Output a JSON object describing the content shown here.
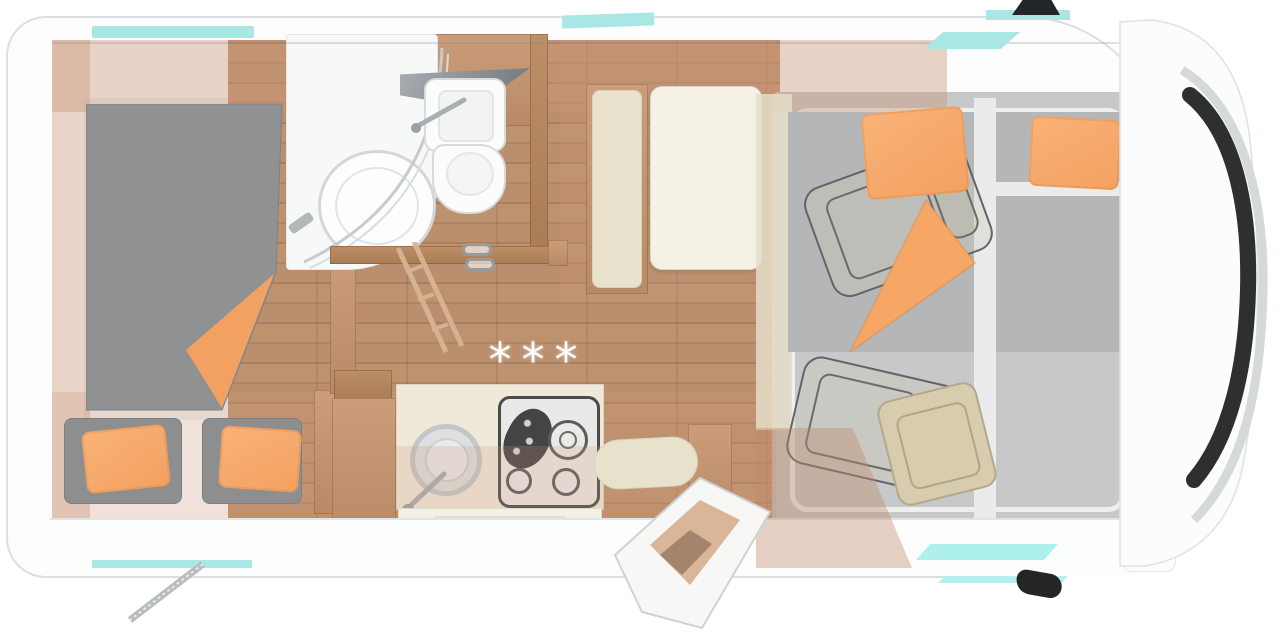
{
  "meta": {
    "description": "Top-down floor plan rendering of a semi-integrated motorhome",
    "view": "top-down"
  },
  "floorplan": {
    "stars_label": "***",
    "elements": [
      {
        "id": "rear-bed",
        "label": "Rear double bed with orange blanket"
      },
      {
        "id": "rear-seats",
        "label": "Rear bench seats with orange pillows"
      },
      {
        "id": "bathroom",
        "label": "Bathroom with shower, washbasin and toilet"
      },
      {
        "id": "wardrobe",
        "label": "Wardrobe / partition wall"
      },
      {
        "id": "kitchen",
        "label": "Kitchen block with round sink and hob"
      },
      {
        "id": "dinette",
        "label": "Dinette with table and bench"
      },
      {
        "id": "entry-door",
        "label": "Open entry door with step"
      },
      {
        "id": "drop-down-bed",
        "label": "Drop-down bed over swivelled cab seats"
      },
      {
        "id": "cab",
        "label": "Driver cab with windscreen"
      }
    ]
  },
  "colors": {
    "accent_cyan": "#a9e7e4",
    "accent_orange": "#f3a162",
    "wood": "#c59877",
    "wood_floor": "#b78c6a",
    "mattress_gray": "#8f9193",
    "cushion_beige": "#e8e2cd",
    "body_white": "#fcfcfd",
    "windshield_dark": "#2e2f30",
    "stars_white": "#ffffff"
  }
}
